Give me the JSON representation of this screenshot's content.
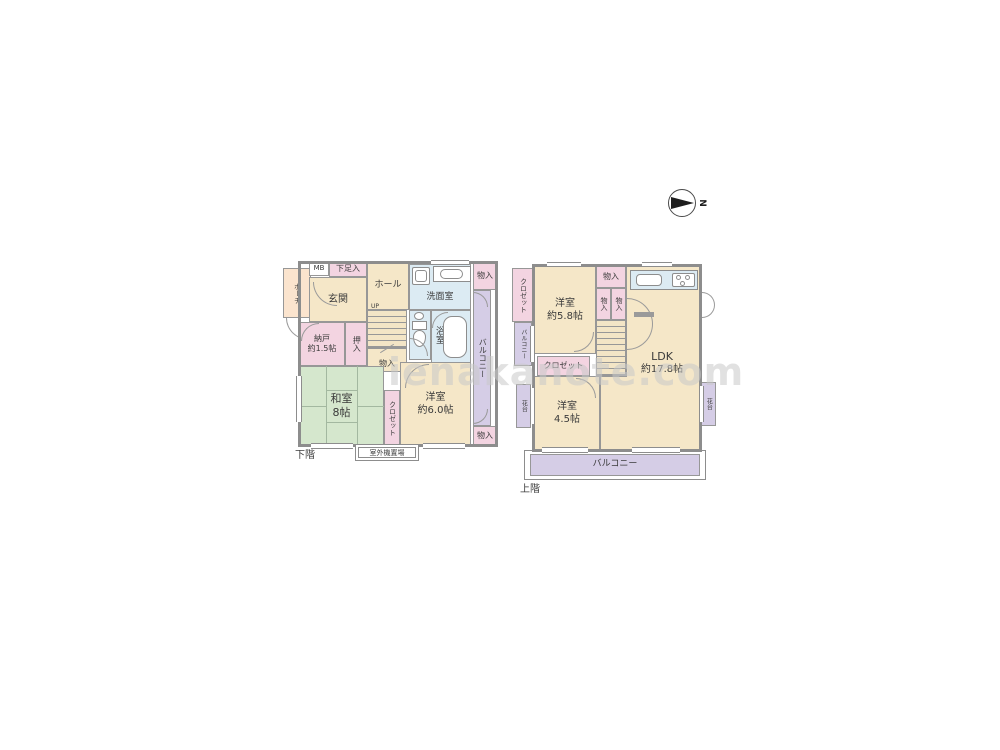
{
  "watermark": "ienakanote.com",
  "compass": {
    "north": "N"
  },
  "colors": {
    "room_cream": "#f5e7c8",
    "tatami_green": "#d5e7cd",
    "storage_pink": "#f3d4e1",
    "balcony_purple": "#d5cde6",
    "wet_area_blue": "#dcebf3",
    "porch_peach": "#fbe4ce",
    "wall_gray": "#8d8d8d"
  },
  "floor1": {
    "label": "下階",
    "porch": "ポーチ",
    "mb": "MB",
    "shoe": "下足入",
    "entrance": "玄関",
    "hall": "ホール",
    "up": "UP",
    "understairs": "物入",
    "washroom": "洗面室",
    "storage_top": "物入",
    "bathroom": "浴室",
    "balcony": "バルコニー",
    "storage_bottom": "物入",
    "storeroom": "納戸",
    "storeroom_size": "約1.5帖",
    "oshiire": "押入",
    "washitsu": "和室",
    "washitsu_size": "8帖",
    "closet": "クロゼット",
    "bedroom": "洋室",
    "bedroom_size": "約6.0帖",
    "outdoor_unit": "室外機置場"
  },
  "floor2": {
    "label": "上階",
    "closet_left": "クロゼット",
    "balcony_left": "バルコニー",
    "bedroom1": "洋室",
    "bedroom1_size": "約5.8帖",
    "storage_top": "物入",
    "storage_a": "物入",
    "storage_b": "物入",
    "ldk": "LDK",
    "ldk_size": "約17.8帖",
    "closet_mid": "クロゼット",
    "bedroom2": "洋室",
    "bedroom2_size": "4.5帖",
    "flower_left": "花台",
    "flower_right": "花台",
    "balcony_bottom": "バルコニー"
  }
}
